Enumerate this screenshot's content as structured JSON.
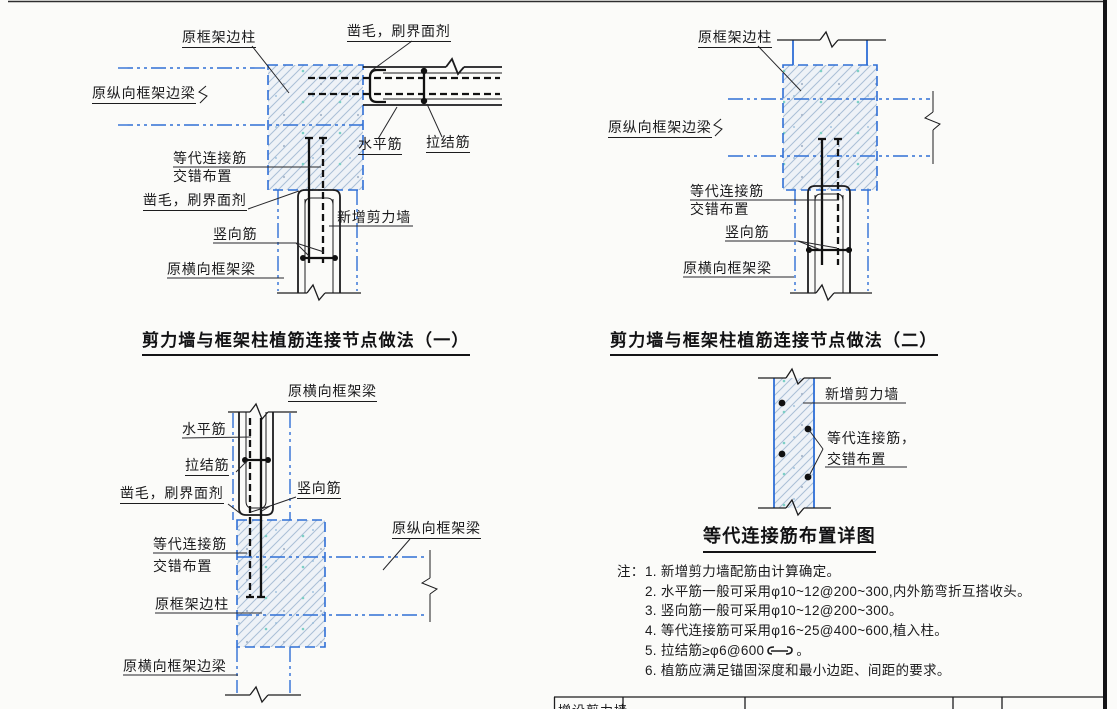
{
  "diagram1": {
    "title": "剪力墙与框架柱植筋连接节点做法（一）",
    "labels": {
      "original_frame_edge_column": "原框架边柱",
      "chisel_interface_agent_top": "凿毛，刷界面剂",
      "original_longitudinal_frame_edge_beam": "原纵向框架边梁",
      "equivalent_connection_bar": "等代连接筋",
      "staggered_arrangement": "交错布置",
      "chisel_interface_agent_bottom": "凿毛，刷界面剂",
      "vertical_bar": "竖向筋",
      "original_transverse_frame_beam": "原横向框架梁",
      "horizontal_bar": "水平筋",
      "tie_bar": "拉结筋",
      "new_shear_wall": "新增剪力墙"
    }
  },
  "diagram2": {
    "title": "剪力墙与框架柱植筋连接节点做法（二）",
    "labels": {
      "original_frame_edge_column": "原框架边柱",
      "original_longitudinal_frame_edge_beam": "原纵向框架边梁",
      "equivalent_connection_bar": "等代连接筋",
      "staggered_arrangement": "交错布置",
      "vertical_bar": "竖向筋",
      "original_transverse_frame_beam": "原横向框架梁"
    }
  },
  "diagram3": {
    "labels": {
      "original_transverse_frame_beam": "原横向框架梁",
      "horizontal_bar": "水平筋",
      "tie_bar": "拉结筋",
      "chisel_interface_agent": "凿毛，刷界面剂",
      "vertical_bar": "竖向筋",
      "equivalent_connection_bar": "等代连接筋",
      "staggered_arrangement": "交错布置",
      "original_frame_edge_column": "原框架边柱",
      "original_longitudinal_frame_beam": "原纵向框架梁",
      "original_transverse_frame_edge_beam": "原横向框架边梁"
    }
  },
  "diagram4": {
    "title": "等代连接筋布置详图",
    "labels": {
      "new_shear_wall": "新增剪力墙",
      "equivalent_connection_bar": "等代连接筋，",
      "staggered_arrangement": "交错布置"
    }
  },
  "notes": {
    "prefix": "注：",
    "item1": "1. 新增剪力墙配筋由计算确定。",
    "item2": "2. 水平筋一般可采用φ10~12@200~300,内外筋弯折互搭收头。",
    "item3": "3. 竖向筋一般可采用φ10~12@200~300。",
    "item4": "4. 等代连接筋可采用φ16~25@400~600,植入柱。",
    "item5_text": "5. 拉结筋≥φ6@600",
    "item5_end": "。",
    "item6": "6. 植筋应满足锚固深度和最小边距、间距的要求。"
  },
  "title_block": {
    "project_cell": "增设剪力墙"
  },
  "colors": {
    "centerline_blue": "#2f6fd6",
    "hatch_line": "#aabfd6",
    "ink_black": "#1c1c1e"
  }
}
